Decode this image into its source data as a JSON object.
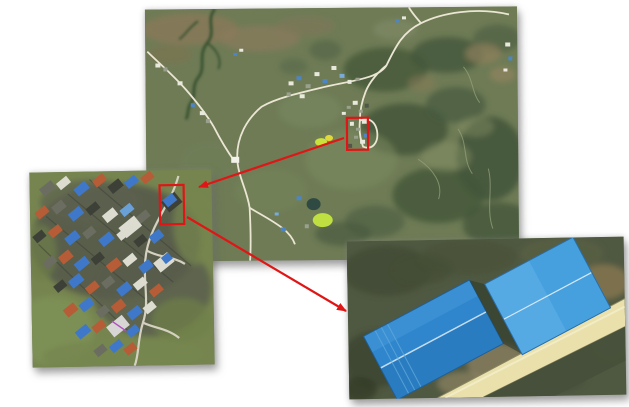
{
  "figure": {
    "kind": "aerial-imagery zoom figure",
    "background_color": "#ffffff",
    "annotation_color": "#e01616"
  },
  "panels": {
    "main": {
      "role": "aerial-overview",
      "left": 146,
      "top": 8,
      "width": 372,
      "height": 252,
      "rotate": -0.5,
      "z": 1
    },
    "village": {
      "role": "village-closeup-inset",
      "left": 31,
      "top": 171,
      "width": 182,
      "height": 195,
      "rotate": -1,
      "z": 2
    },
    "warehouse": {
      "role": "blue-warehouse-closeup-inset",
      "left": 348,
      "top": 239,
      "width": 277,
      "height": 158,
      "rotate": -1,
      "z": 3
    }
  },
  "annotations": {
    "stroke_width": 2.2,
    "regions": [
      {
        "panel": "main",
        "x": 201,
        "y": 110,
        "width": 21,
        "height": 32
      },
      {
        "panel": "village",
        "x": 130,
        "y": 15,
        "width": 24,
        "height": 39
      }
    ],
    "arrows": [
      {
        "x1": 344,
        "y1": 138,
        "x2": 199,
        "y2": 187
      },
      {
        "x1": 187,
        "y1": 217,
        "x2": 346,
        "y2": 311
      }
    ]
  },
  "palette": {
    "terrain_olive": "#6e7b55",
    "forest_dark": "#44573a",
    "road_light": "#ebe6d4",
    "grass_green": "#76854f",
    "roof_blue": "#3f78c8",
    "roof_orange": "#b65c36",
    "warehouse_blue": "#2f86cc",
    "warehouse_blue_light": "#47a0de",
    "dirt_road_yellow": "#e9e0ac"
  }
}
